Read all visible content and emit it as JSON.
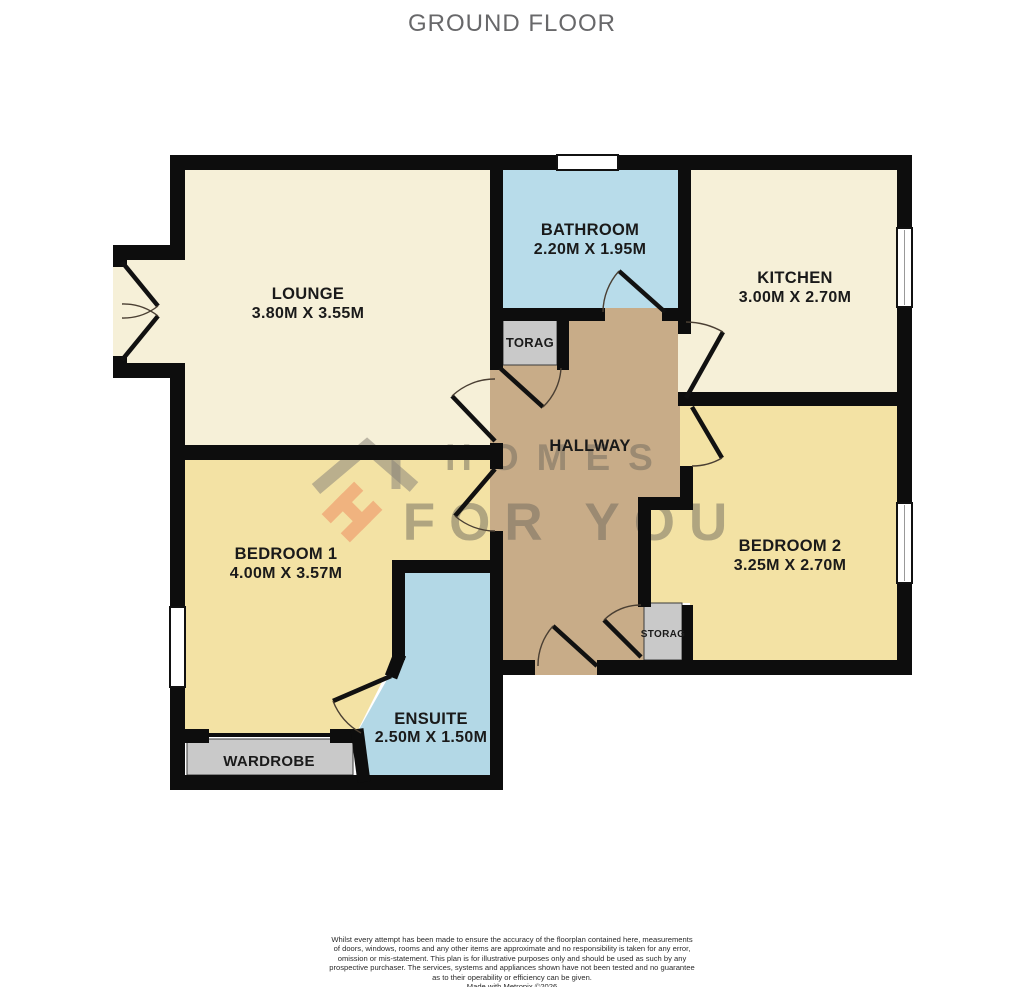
{
  "title": "GROUND FLOOR",
  "rooms": {
    "lounge": {
      "name": "LOUNGE",
      "dims": "3.80M X 3.55M"
    },
    "bathroom": {
      "name": "BATHROOM",
      "dims": "2.20M X 1.95M"
    },
    "kitchen": {
      "name": "KITCHEN",
      "dims": "3.00M X 2.70M"
    },
    "bedroom1": {
      "name": "BEDROOM 1",
      "dims": "4.00M X 3.57M"
    },
    "bedroom2": {
      "name": "BEDROOM 2",
      "dims": "3.25M X 2.70M"
    },
    "ensuite": {
      "name": "ENSUITE",
      "dims": "2.50M X 1.50M"
    },
    "hallway": {
      "name": "HALLWAY"
    },
    "wardrobe": {
      "name": "WARDROBE"
    },
    "storage_top": {
      "name": "TORAG"
    },
    "storage_bottom": {
      "name": "STORAG"
    }
  },
  "watermark": {
    "line1": "HOMES",
    "line2": "FOR YOU"
  },
  "footer": {
    "lines": [
      "Whilst every attempt has been made to ensure the accuracy of the floorplan contained here, measurements",
      "of doors, windows, rooms and any other items are approximate and no responsibility is taken for any error,",
      "omission or mis-statement. This plan is for illustrative purposes only and should be used as such by any",
      "prospective purchaser. The services, systems and appliances shown have not been tested and no guarantee",
      "as to their operability or efficiency can be given.",
      "Made with Metropix ©2026"
    ]
  },
  "colors": {
    "wall": "#0d0d0d",
    "lounge_kitchen_fill": "#f6f0d8",
    "bedroom_fill": "#f3e2a4",
    "bathroom_fill": "#b8dcea",
    "ensuite_fill": "#b3d8e6",
    "hallway_fill": "#c8ac88",
    "storage_fill": "#c9c9c9",
    "watermark_gray": "#6f695d",
    "logo_orange": "#f0a070",
    "title_gray": "#68686a"
  }
}
